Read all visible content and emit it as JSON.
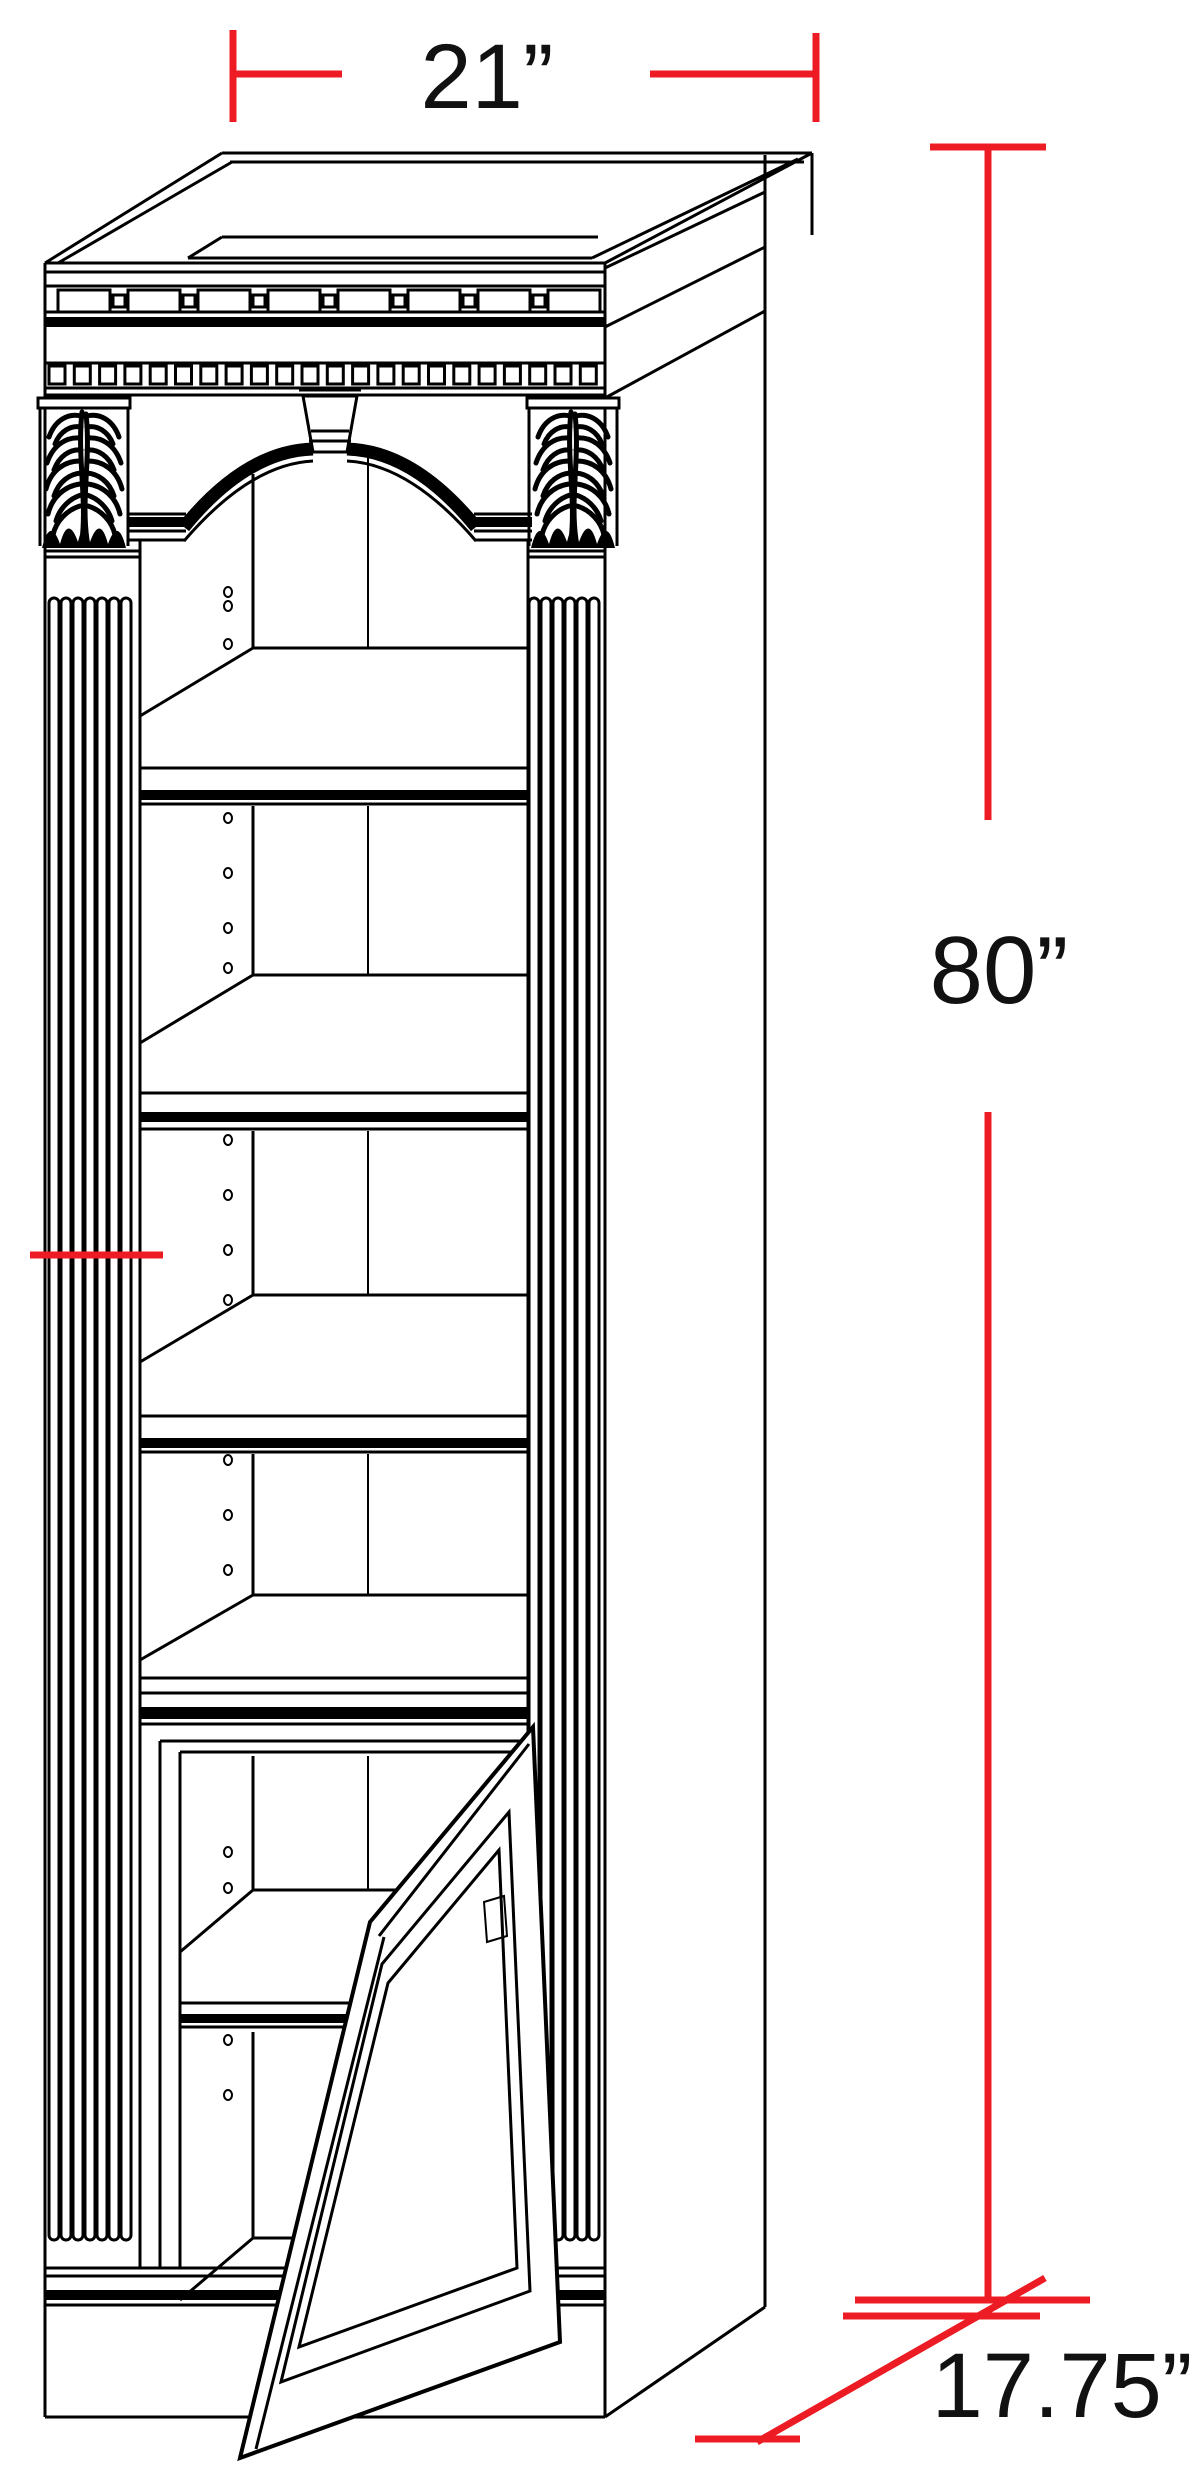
{
  "drawing": {
    "type": "furniture-dimension-diagram",
    "subject": "Tall bookcase with arched open shelving and lower cabinet door shown open",
    "dimension_labels": {
      "width": "21”",
      "height": "80”",
      "depth": "17.75”"
    },
    "colors": {
      "dimension_line": "#ed1c24",
      "drawing_line": "#000000",
      "background": "#ffffff"
    }
  }
}
